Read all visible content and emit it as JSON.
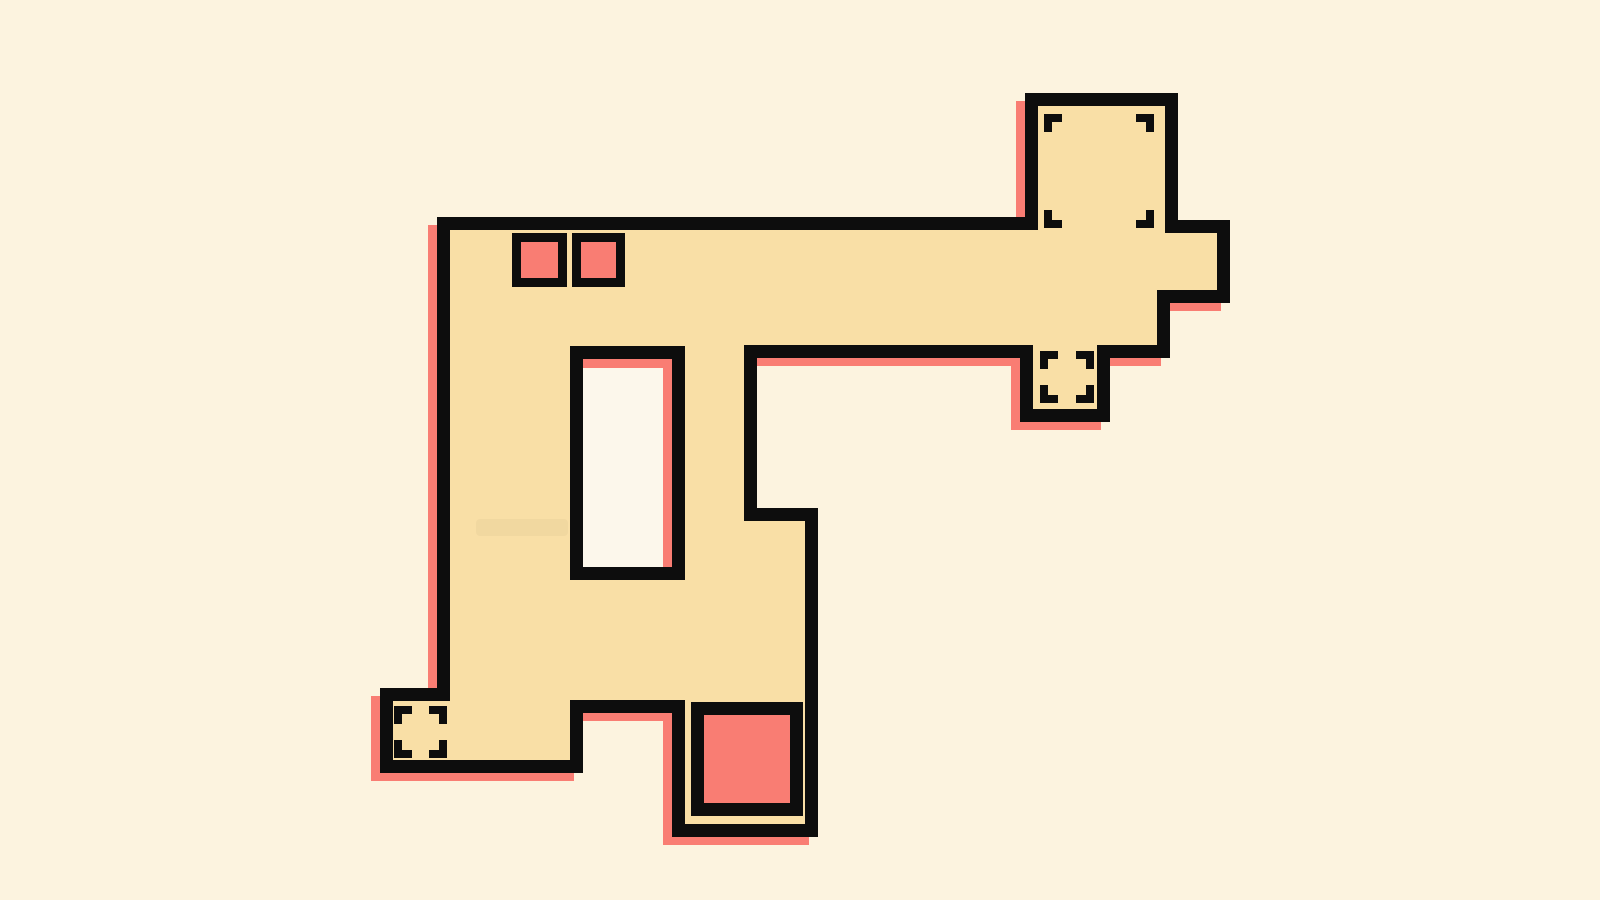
{
  "scene": {
    "background_color": "#FCF3DF",
    "floor_color": "#F9DFA6",
    "outline_color": "#0D0D0D",
    "shadow_color": "#F97D73",
    "accent_red": "#F97D73",
    "hole_fill_color": "#FCF7EB",
    "outline_width": 13,
    "shadow_offset": {
      "dx": -9,
      "dy": 8
    },
    "viewbox": [
      0,
      0,
      1600,
      900
    ]
  },
  "floor_plan": {
    "outline_points": [
      [
        443.5,
        223.5
      ],
      [
        1031.5,
        223.5
      ],
      [
        1031.5,
        99.5
      ],
      [
        1171.5,
        99.5
      ],
      [
        1171.5,
        226.5
      ],
      [
        1223.5,
        226.5
      ],
      [
        1223.5,
        296.5
      ],
      [
        1163.5,
        296.5
      ],
      [
        1163.5,
        351.5
      ],
      [
        1103.5,
        351.5
      ],
      [
        1103.5,
        415.5
      ],
      [
        1026.5,
        415.5
      ],
      [
        1026.5,
        351.5
      ],
      [
        750.5,
        351.5
      ],
      [
        750.5,
        514.5
      ],
      [
        811.5,
        514.5
      ],
      [
        811.5,
        830.5
      ],
      [
        678.5,
        830.5
      ],
      [
        678.5,
        706.5
      ],
      [
        576.5,
        706.5
      ],
      [
        576.5,
        766.5
      ],
      [
        386.5,
        766.5
      ],
      [
        386.5,
        694.5
      ],
      [
        443.5,
        694.5
      ]
    ],
    "hole_rect": {
      "x": 576.5,
      "y": 352.5,
      "w": 102,
      "h": 221
    },
    "hole_interior": {
      "x": 583,
      "y": 359,
      "w": 89,
      "h": 208
    },
    "hole_shadow_strips": [
      {
        "x": 583,
        "y": 359,
        "w": 89,
        "h": 9
      },
      {
        "x": 663,
        "y": 359,
        "w": 9,
        "h": 208
      }
    ]
  },
  "markers": {
    "small_red_squares": [
      {
        "x": 516.5,
        "y": 237.5,
        "w": 46,
        "h": 45,
        "border": 9
      },
      {
        "x": 576.5,
        "y": 237.5,
        "w": 44,
        "h": 45,
        "border": 9
      }
    ],
    "large_red_square": {
      "x": 697.5,
      "y": 708.5,
      "w": 99,
      "h": 101,
      "border": 13
    },
    "target_rooms": [
      {
        "id": "top-right-room",
        "x": 1044,
        "y": 114,
        "w": 110,
        "h": 114
      },
      {
        "id": "mid-right-room",
        "x": 1040,
        "y": 351,
        "w": 54,
        "h": 52
      },
      {
        "id": "bottom-left-room",
        "x": 394,
        "y": 706,
        "w": 53,
        "h": 52
      }
    ],
    "corner_bracket": {
      "arm": 18,
      "thickness": 8
    }
  },
  "decor": {
    "floor_smudge": {
      "x": 476,
      "y": 519,
      "w": 92,
      "h": 17,
      "opacity": 0.03
    }
  }
}
